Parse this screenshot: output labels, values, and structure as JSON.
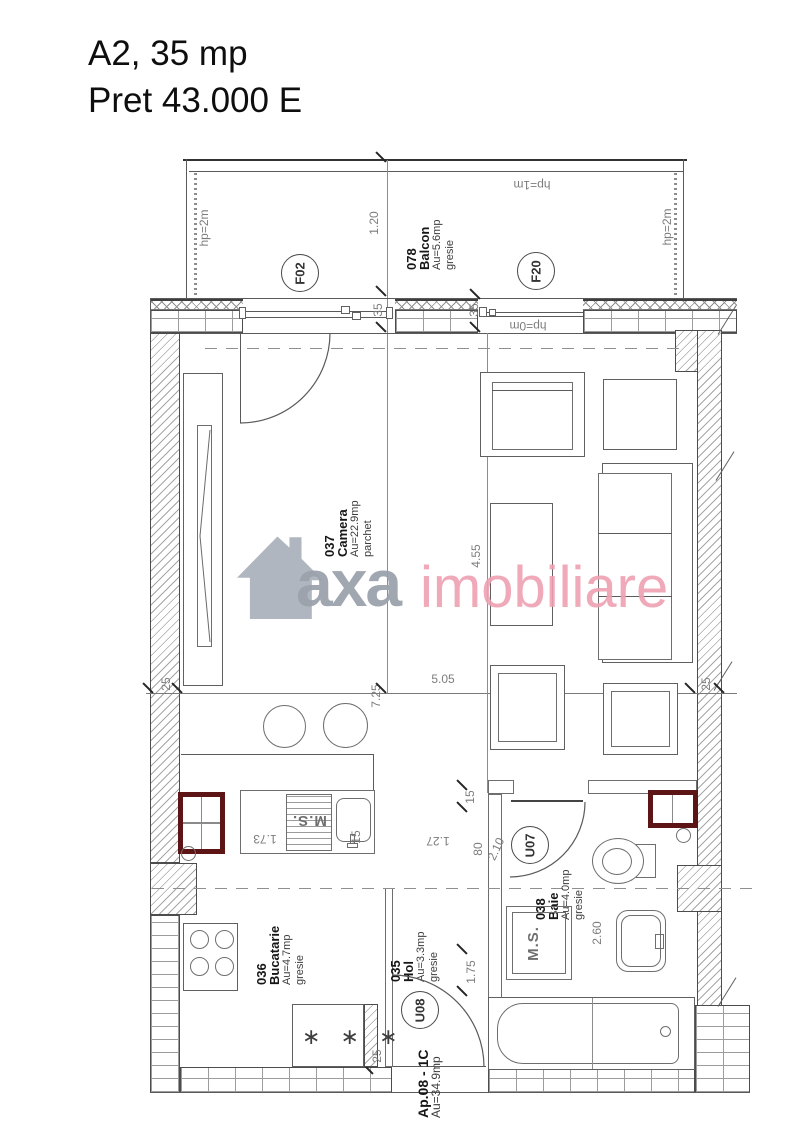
{
  "title": {
    "line1": "A2, 35 mp",
    "line2": "Pret 43.000 E"
  },
  "watermark": {
    "gray_text": "axa",
    "pink_text": "imobiliare"
  },
  "apartment_label": {
    "name": "Ap.08 - 1C",
    "area": "Au=34.9mp"
  },
  "rooms": {
    "balcon": {
      "id": "078",
      "name": "Balcon",
      "area": "Au=5.6mp",
      "floor": "gresie"
    },
    "camera": {
      "id": "037",
      "name": "Camera",
      "area": "Au=22.9mp",
      "floor": "parchet"
    },
    "bucatarie": {
      "id": "036",
      "name": "Bucatarie",
      "area": "Au=4.7mp",
      "floor": "gresie"
    },
    "hol": {
      "id": "035",
      "name": "Hol",
      "area": "Au=3.3mp",
      "floor": "gresie"
    },
    "baie": {
      "id": "038",
      "name": "Baie",
      "area": "Au=4.0mp",
      "floor": "gresie"
    }
  },
  "openings": {
    "f02": "F02",
    "f20": "F20",
    "u07": "U07",
    "u08": "U08"
  },
  "parapet_heights": {
    "left": "hp=2m",
    "right": "hp=2m",
    "top": "hp=1m",
    "window": "hp=0m"
  },
  "dimensions": {
    "balcony_depth": "1.20",
    "jamb_left": "35",
    "jamb_right": "35",
    "camera_length": "4.55",
    "camera_width": "5.05",
    "interior_width": "7.25",
    "wall_left": "25",
    "wall_right": "25",
    "wall_bottom": "25",
    "counter": "1.73",
    "gap_kitchen": "15",
    "gap_bath": "15",
    "hall_segment": "1.27",
    "bath_door": "80",
    "bath_wall": "2.10",
    "bath_length": "2.60",
    "hall_width": "1.75"
  },
  "fixtures": {
    "washer_label": "M.S.",
    "freezer_stars": "∗ ∗ ∗"
  },
  "colors": {
    "radiator": "#5c1414",
    "wall_line": "#4c4c4c",
    "furniture_line": "#606060",
    "hatch": "#a6a6a6",
    "dim_text": "#7c7c7c",
    "brand_gray": "#9ca3ac",
    "brand_pink": "#efa0b1"
  }
}
